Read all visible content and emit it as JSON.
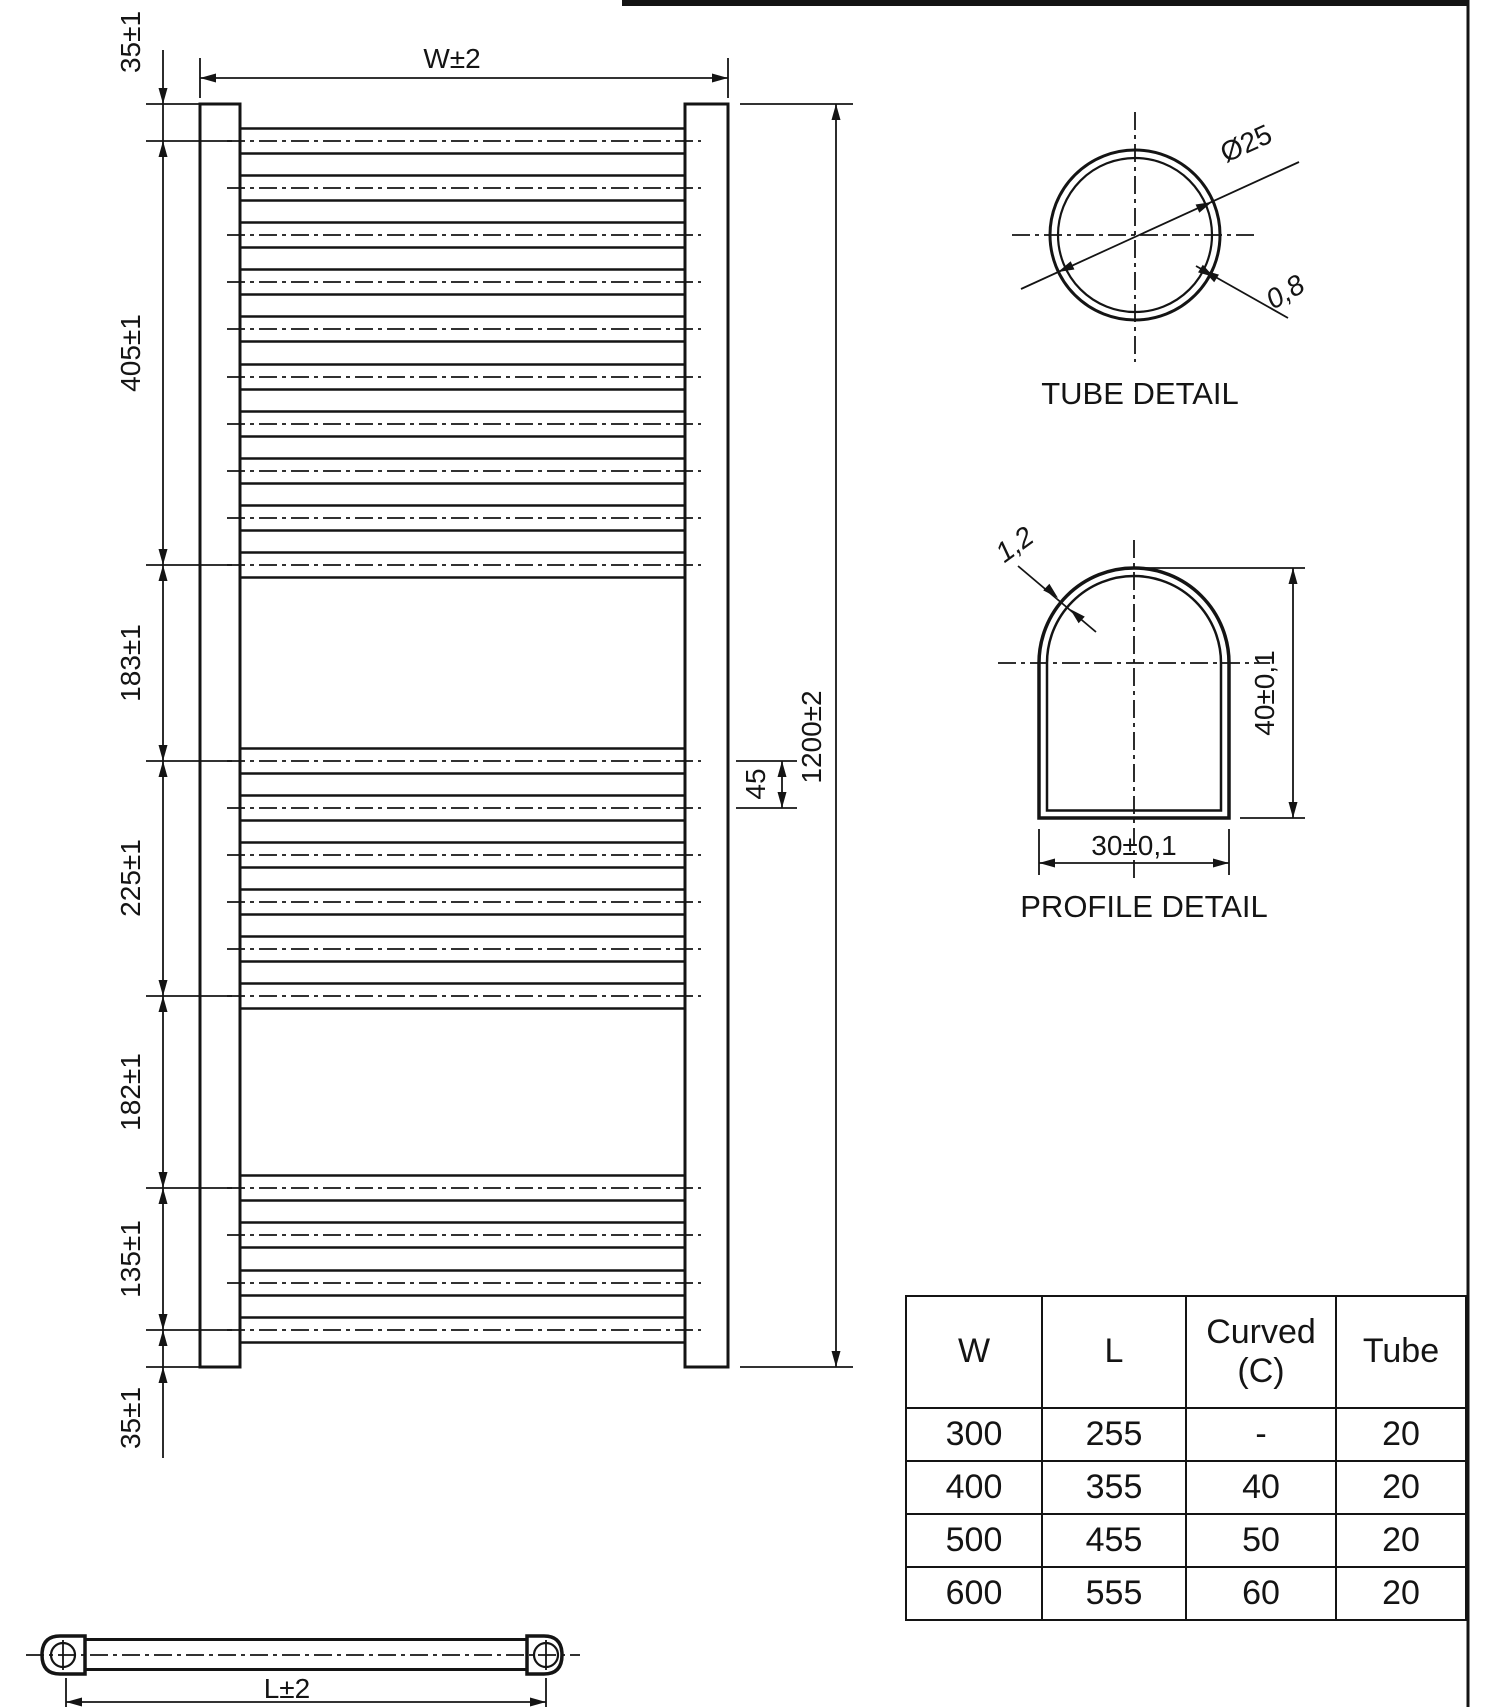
{
  "front_view": {
    "width_dim": "W±2",
    "height_dim": "1200±2",
    "rung_spacing_dim": "45",
    "left_dims": [
      "35±1",
      "405±1",
      "183±1",
      "225±1",
      "182±1",
      "135±1",
      "35±1"
    ]
  },
  "tube_detail": {
    "title": "TUBE DETAIL",
    "diameter_dim": "Ø25",
    "wall_dim": "0,8"
  },
  "profile_detail": {
    "title": "PROFILE DETAIL",
    "wall_dim": "1,2",
    "height_dim": "40±0,1",
    "width_dim": "30±0,1"
  },
  "side_view": {
    "length_dim": "L±2"
  },
  "size_table": {
    "headers": [
      "W",
      "L",
      "Curved (C)",
      "Tube"
    ],
    "rows": [
      [
        "300",
        "255",
        "-",
        "20"
      ],
      [
        "400",
        "355",
        "40",
        "20"
      ],
      [
        "500",
        "455",
        "50",
        "20"
      ],
      [
        "600",
        "555",
        "60",
        "20"
      ]
    ]
  }
}
